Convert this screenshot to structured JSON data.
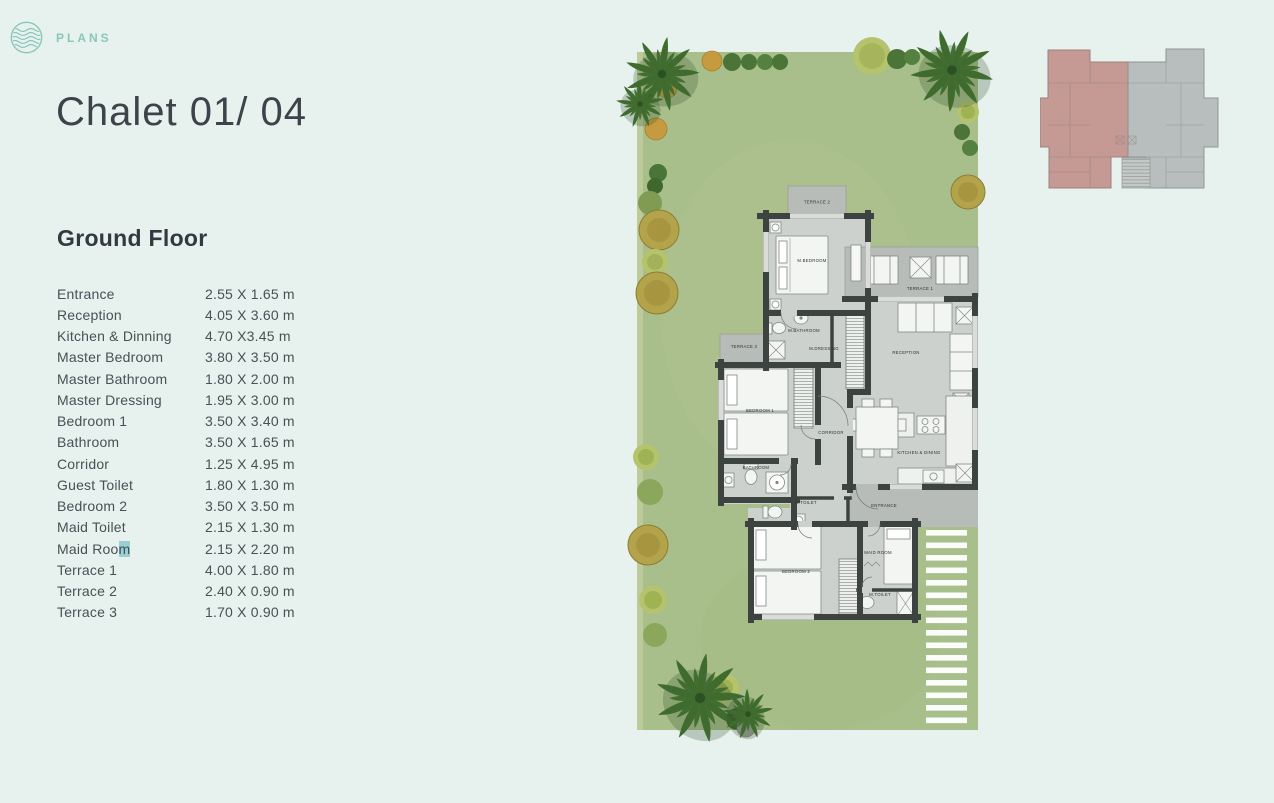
{
  "theme": {
    "background": "#e7f2ee",
    "accent_teal": "#8ac7ba",
    "title_color": "#3c434a",
    "text_color": "#495056",
    "garden_green": "#a9bf8b",
    "floor_gray": "#ccd1cd",
    "terrace_gray": "#b7bcb8",
    "wall_dark": "#3d4341",
    "selection_highlight": "#9fccd3",
    "overview_selected_fill": "#c59a95",
    "overview_other_fill": "#b7bebd"
  },
  "header": {
    "brand": "PLANS"
  },
  "page": {
    "title": "Chalet 01/ 04",
    "section_heading": "Ground Floor"
  },
  "rooms": [
    {
      "label": "Entrance",
      "size": "2.55 X 1.65 m"
    },
    {
      "label": "Reception",
      "size": "4.05 X 3.60 m"
    },
    {
      "label": "Kitchen &  Dinning",
      "size": "4.70 X3.45 m"
    },
    {
      "label": "Master Bedroom",
      "size": "3.80 X 3.50 m"
    },
    {
      "label": "Master Bathroom",
      "size": "1.80 X 2.00 m"
    },
    {
      "label": "Master Dressing",
      "size": "1.95 X 3.00 m"
    },
    {
      "label": "Bedroom 1",
      "size": "3.50 X 3.40 m"
    },
    {
      "label": "Bathroom",
      "size": "3.50 X 1.65 m"
    },
    {
      "label": "Corridor",
      "size": "1.25 X 4.95 m"
    },
    {
      "label": "Guest Toilet",
      "size": "1.80 X 1.30 m"
    },
    {
      "label": "Bedroom 2",
      "size": "3.50 X 3.50 m"
    },
    {
      "label": "Maid Toilet",
      "size": "2.15 X 1.30 m"
    },
    {
      "label": "Maid Room",
      "label_pre": "Maid Roo",
      "label_hl": "m",
      "size": "2.15 X 2.20 m"
    },
    {
      "label": "Terrace 1",
      "size": "4.00 X 1.80 m"
    },
    {
      "label": "Terrace 2",
      "size": "2.40 X 0.90 m"
    },
    {
      "label": "Terrace 3",
      "size": "1.70 X 0.90 m"
    }
  ],
  "floorplan": {
    "labels": {
      "terrace2": "TERRACE 2",
      "m_bedroom": "M.BEDROOM",
      "m_bathroom": "M.BATHROOM",
      "m_dressing": "M.DRESSING",
      "terrace1": "TERRACE 1",
      "reception": "RECEPTION",
      "terrace3": "TERRACE 3",
      "bedroom1": "BEDROOM 1",
      "corridor": "CORRIDOR",
      "kitchen_dining": "KITCHEN & DINING",
      "bathroom": "BATHROOM",
      "g_toilet": "G.TOILET",
      "entrance": "ENTRANCE",
      "bedroom2": "BEDROOM 2",
      "maid_room": "MAID ROOM",
      "m_toilet": "M.TOILET"
    }
  }
}
